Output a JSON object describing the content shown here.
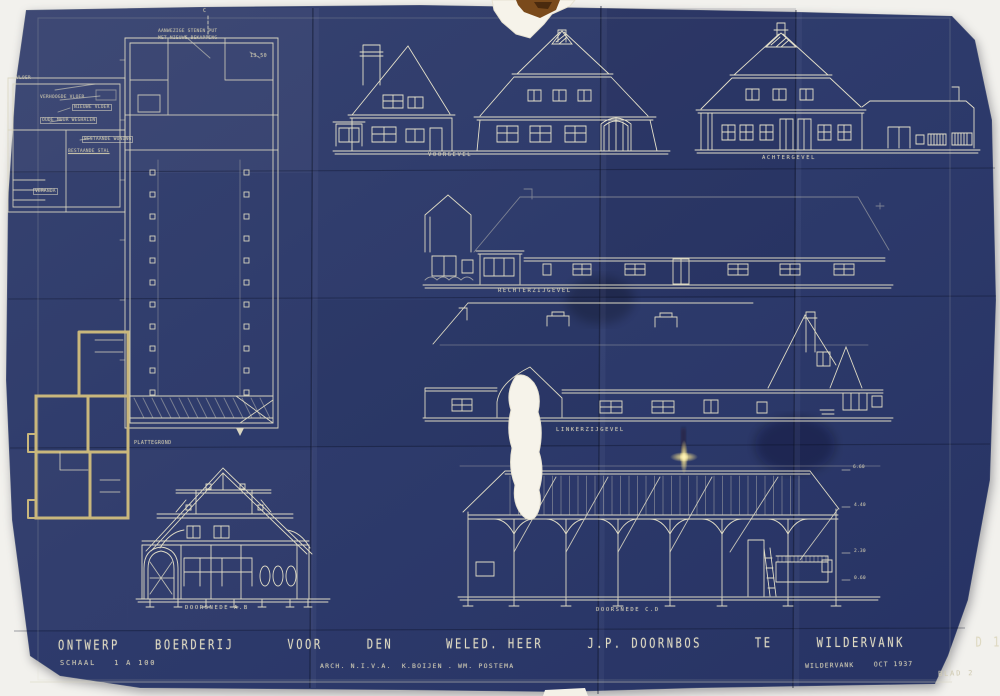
{
  "sheet": {
    "kind": "architectural blueprint, cyanotype photo",
    "colors": {
      "paper": "#2e3b6c",
      "paper_dark": "#273460",
      "ink": "#d9d5c0",
      "wall_yellow": "#c9b77c",
      "tear_white": "#f6f3ea",
      "stain_brown": "#7a4a1b",
      "glint_yellow": "#ffe98a"
    }
  },
  "labels": {
    "note1": "AANWEZIGE STENEN PUT",
    "note2": "MET NIEUWE BEKAPPING",
    "note_dim": "13.50",
    "marker_c": "C",
    "vloer": "VLOER",
    "verhoogde_vloer": "VERHOOGDE VLOER",
    "nieuwe_vloer": "NIEUWE VLOER",
    "oude_muur": "OUDE MUUR WEGHALEN",
    "bestaande_woning": "BESTAANDE WONING",
    "bestaande_stal": "BESTAANDE STAL",
    "veranda": "VERANDA",
    "plattegrond": "PLATTEGROND",
    "voorgevel": "VOORGEVEL",
    "achtergevel": "ACHTERGEVEL",
    "rechterzijgevel": "RECHTERZIJGEVEL",
    "linkerzijgevel": "LINKERZIJGEVEL",
    "doorsnede_ab": "DOORSNEDE A.B",
    "doorsnede_cd": "DOORSNEDE C.D",
    "dim1": "6.60",
    "dim2": "4.40",
    "dim3": "2.30",
    "dim4": "0.60"
  },
  "title_block": {
    "line1": "ONTWERP    BOERDERIJ      VOOR     DEN      WELED. HEER     J.P. DOORNBOS      TE     WILDERVANK        D 16",
    "schaal": "SCHAAL   1 A 100",
    "architect": "ARCH. N.I.V.A.  K.BOIJEN . WM. POSTEMA",
    "place_date": "WILDERVANK    OCT 1937",
    "sheet_no": "BLAD 2"
  }
}
